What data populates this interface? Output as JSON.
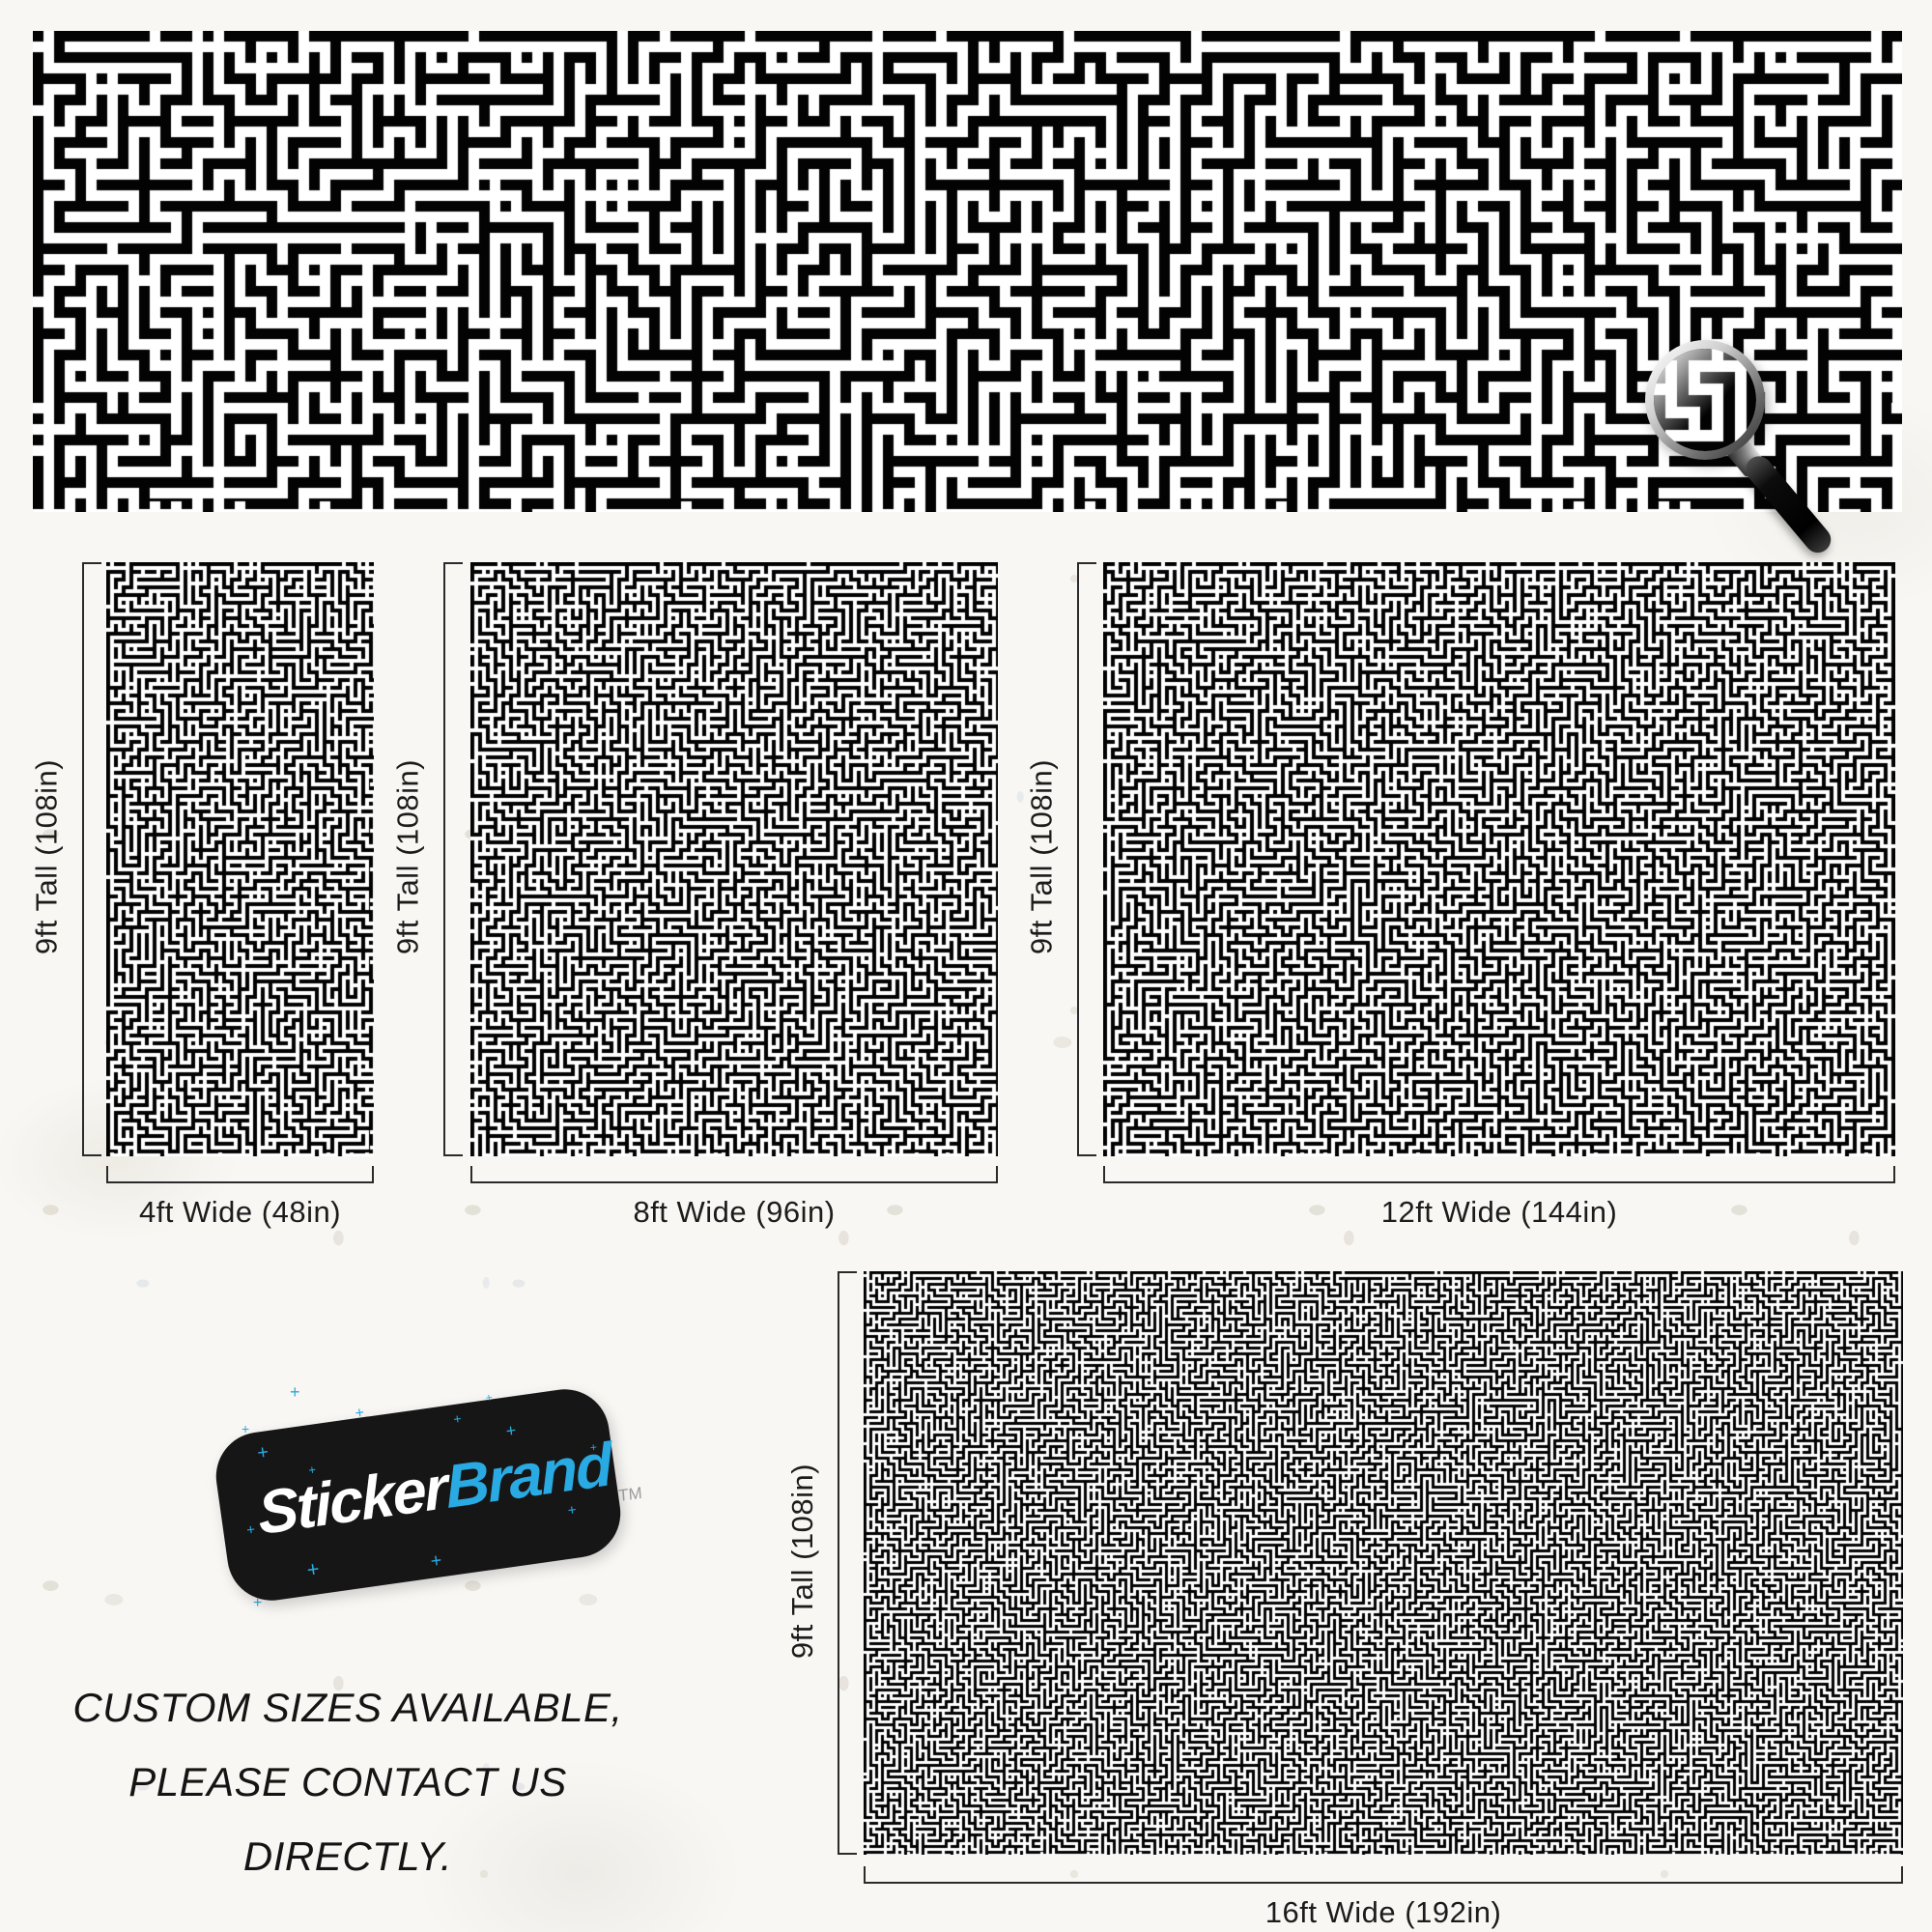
{
  "product": {
    "pattern_name": "black-and-white-maze-wall-mural",
    "colors": {
      "ink": "#000000",
      "paper": "#ffffff",
      "background": "#f8f7f4",
      "accent_blue": "#29aae2"
    },
    "sizes": [
      {
        "tall": "9ft Tall (108in)",
        "wide": "4ft Wide (48in)"
      },
      {
        "tall": "9ft Tall (108in)",
        "wide": "8ft Wide (96in)"
      },
      {
        "tall": "9ft Tall (108in)",
        "wide": "12ft Wide (144in)"
      },
      {
        "tall": "9ft Tall (108in)",
        "wide": "16ft Wide (192in)"
      }
    ],
    "brand": {
      "word1": "Sticker",
      "word2": "Brand",
      "trademark": "TM",
      "sparkle_char": "+",
      "card_color": "#161616",
      "blue": "#29aae2"
    },
    "notice": {
      "line1": "CUSTOM SIZES AVAILABLE,",
      "line2": "PLEASE CONTACT US DIRECTLY."
    },
    "icons": {
      "magnifier": "magnifying-glass-icon",
      "sparkle": "sparkle-plus-icon"
    }
  }
}
